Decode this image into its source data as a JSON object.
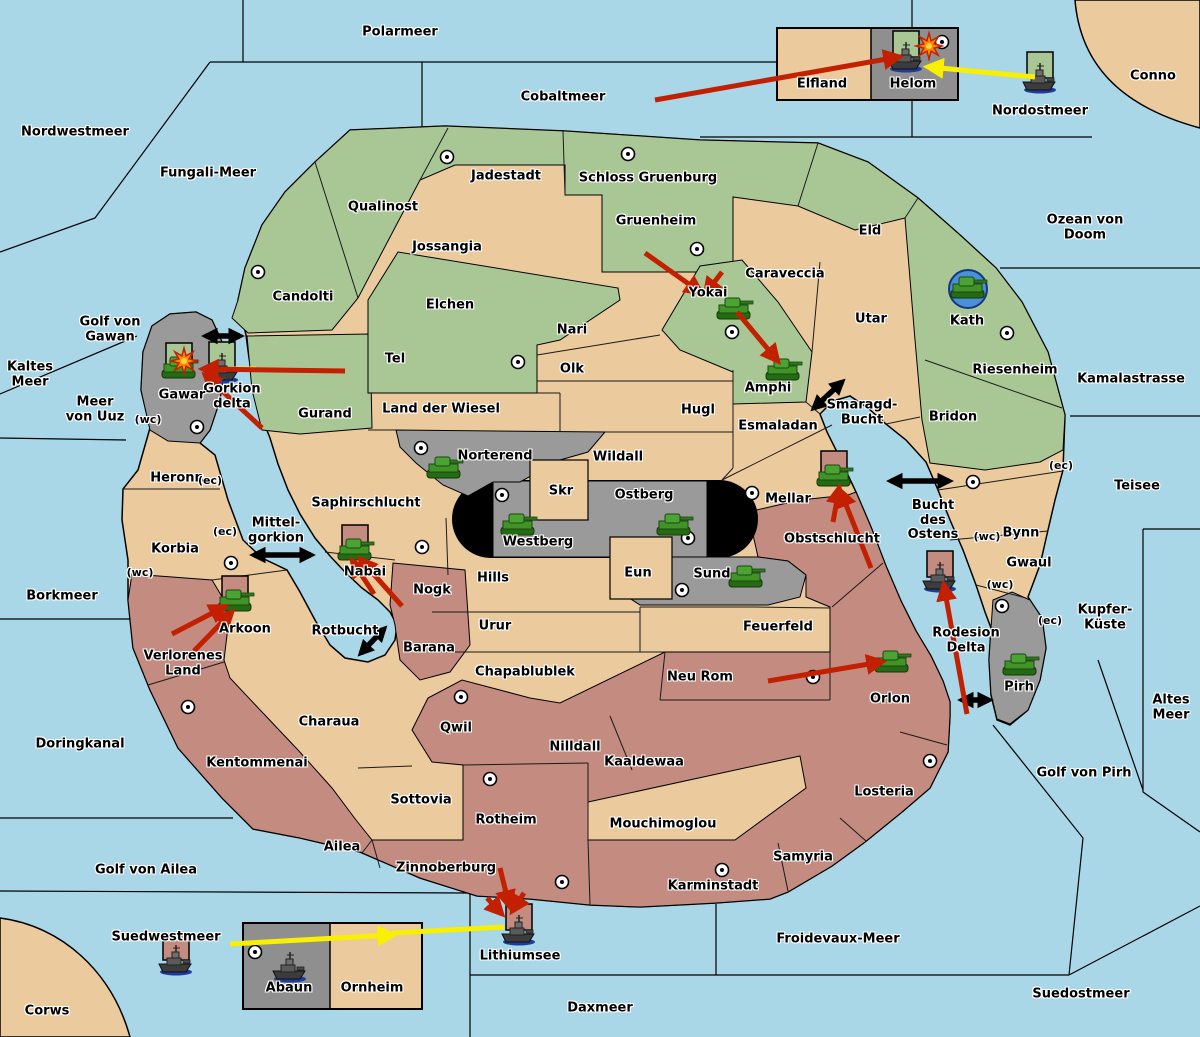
{
  "palette": {
    "sea": "#A9D7E8",
    "tan": "#EBCA9E",
    "green": "#A9C795",
    "gray": "#9A9A9A",
    "dark_gray": "#8F8F8F",
    "rose": "#C48B80",
    "black": "#000000",
    "red": "#C22000",
    "yellow": "#F8F000",
    "explosion": "#FF8A00",
    "city_fill": "#FFFFFF",
    "flag_green": "#A9C795",
    "flag_rose": "#C48B80",
    "kath_circle": "#4A90D9"
  },
  "seas": [
    {
      "name": "Polarmeer",
      "x": 400,
      "y": 33
    },
    {
      "name": "Cobaltmeer",
      "x": 563,
      "y": 98
    },
    {
      "name": "Nordwestmeer",
      "x": 75,
      "y": 133
    },
    {
      "name": "Fungali-Meer",
      "x": 208,
      "y": 174
    },
    {
      "name": "Nordostmeer",
      "x": 1040,
      "y": 112
    },
    {
      "name": "Ozean von Doom",
      "x": 1085,
      "y": 228
    },
    {
      "name": "Kamalastrasse",
      "x": 1131,
      "y": 380
    },
    {
      "name": "Kaltes\nMeer",
      "x": 30,
      "y": 375
    },
    {
      "name": "Golf von\nGawan",
      "x": 110,
      "y": 330
    },
    {
      "name": "Meer\nvon Uuz",
      "x": 95,
      "y": 410
    },
    {
      "name": "Teisee",
      "x": 1137,
      "y": 487
    },
    {
      "name": "Borkmeer",
      "x": 62,
      "y": 597
    },
    {
      "name": "Kupfer-\nKüste",
      "x": 1105,
      "y": 618
    },
    {
      "name": "Altes\nMeer",
      "x": 1171,
      "y": 708
    },
    {
      "name": "Doringkanal",
      "x": 80,
      "y": 745
    },
    {
      "name": "Golf von Pirh",
      "x": 1084,
      "y": 774
    },
    {
      "name": "Golf von Ailea",
      "x": 146,
      "y": 871
    },
    {
      "name": "Suedwestmeer",
      "x": 166,
      "y": 938
    },
    {
      "name": "Daxmeer",
      "x": 600,
      "y": 1009
    },
    {
      "name": "Froidevaux-Meer",
      "x": 838,
      "y": 940
    },
    {
      "name": "Suedostmeer",
      "x": 1081,
      "y": 995
    },
    {
      "name": "Lithiumsee",
      "x": 520,
      "y": 957
    },
    {
      "name": "Smaragd-\nBucht",
      "x": 862,
      "y": 413
    },
    {
      "name": "Bucht\ndes\nOstens",
      "x": 933,
      "y": 521
    },
    {
      "name": "Mittel-\ngorkion",
      "x": 276,
      "y": 531
    },
    {
      "name": "Rotbucht",
      "x": 345,
      "y": 632
    },
    {
      "name": "Gorkion\ndelta",
      "x": 232,
      "y": 397
    },
    {
      "name": "Rodesion\nDelta",
      "x": 966,
      "y": 641
    }
  ],
  "regions": [
    {
      "name": "Jadestadt",
      "x": 506,
      "y": 177,
      "terrain": "green"
    },
    {
      "name": "Schloss Gruenburg",
      "x": 648,
      "y": 179,
      "terrain": "green"
    },
    {
      "name": "Qualinost",
      "x": 383,
      "y": 208,
      "terrain": "green"
    },
    {
      "name": "Jossangia",
      "x": 447,
      "y": 248,
      "terrain": "tan"
    },
    {
      "name": "Gruenheim",
      "x": 656,
      "y": 222,
      "terrain": "green"
    },
    {
      "name": "Candolti",
      "x": 303,
      "y": 298,
      "terrain": "green"
    },
    {
      "name": "Elchen",
      "x": 450,
      "y": 306,
      "terrain": "green"
    },
    {
      "name": "Caraveccia",
      "x": 785,
      "y": 275,
      "terrain": "tan"
    },
    {
      "name": "Eld",
      "x": 870,
      "y": 232,
      "terrain": "green"
    },
    {
      "name": "Utar",
      "x": 871,
      "y": 320,
      "terrain": "tan"
    },
    {
      "name": "Kath",
      "x": 967,
      "y": 322,
      "terrain": "green"
    },
    {
      "name": "Yokai",
      "x": 708,
      "y": 294,
      "terrain": "green"
    },
    {
      "name": "Nari",
      "x": 572,
      "y": 331,
      "terrain": "tan"
    },
    {
      "name": "Tel",
      "x": 395,
      "y": 360,
      "terrain": "green"
    },
    {
      "name": "Olk",
      "x": 572,
      "y": 370,
      "terrain": "tan"
    },
    {
      "name": "Riesenheim",
      "x": 1015,
      "y": 371,
      "terrain": "green"
    },
    {
      "name": "Bridon",
      "x": 953,
      "y": 418,
      "terrain": "tan"
    },
    {
      "name": "Land der Wiesel",
      "x": 441,
      "y": 410,
      "terrain": "tan"
    },
    {
      "name": "Hugl",
      "x": 698,
      "y": 411,
      "terrain": "tan"
    },
    {
      "name": "Esmaladan",
      "x": 778,
      "y": 427,
      "terrain": "tan"
    },
    {
      "name": "Amphi",
      "x": 768,
      "y": 389,
      "terrain": "green"
    },
    {
      "name": "Gurand",
      "x": 325,
      "y": 415,
      "terrain": "green"
    },
    {
      "name": "Norterend",
      "x": 495,
      "y": 457,
      "terrain": "gray"
    },
    {
      "name": "Wildall",
      "x": 618,
      "y": 458,
      "terrain": "tan"
    },
    {
      "name": "Skr",
      "x": 561,
      "y": 492,
      "terrain": "tan"
    },
    {
      "name": "Ostberg",
      "x": 644,
      "y": 496,
      "terrain": "gray"
    },
    {
      "name": "Mellar",
      "x": 788,
      "y": 500,
      "terrain": "tan"
    },
    {
      "name": "Saphirschlucht",
      "x": 366,
      "y": 504,
      "terrain": "tan"
    },
    {
      "name": "Westberg",
      "x": 538,
      "y": 543,
      "terrain": "gray"
    },
    {
      "name": "Obstschlucht",
      "x": 832,
      "y": 540,
      "terrain": "rose"
    },
    {
      "name": "Bynn",
      "x": 1021,
      "y": 534,
      "terrain": "tan"
    },
    {
      "name": "Heronn",
      "x": 177,
      "y": 479,
      "terrain": "tan"
    },
    {
      "name": "Gwaul",
      "x": 1029,
      "y": 564,
      "terrain": "tan"
    },
    {
      "name": "Korbia",
      "x": 175,
      "y": 550,
      "terrain": "tan"
    },
    {
      "name": "Nabai",
      "x": 365,
      "y": 573,
      "terrain": "tan"
    },
    {
      "name": "Nogk",
      "x": 432,
      "y": 591,
      "terrain": "rose"
    },
    {
      "name": "Hills",
      "x": 493,
      "y": 579,
      "terrain": "tan"
    },
    {
      "name": "Eun",
      "x": 638,
      "y": 574,
      "terrain": "tan"
    },
    {
      "name": "Sund",
      "x": 712,
      "y": 575,
      "terrain": "gray"
    },
    {
      "name": "Urur",
      "x": 495,
      "y": 627,
      "terrain": "tan"
    },
    {
      "name": "Feuerfeld",
      "x": 778,
      "y": 628,
      "terrain": "tan"
    },
    {
      "name": "Arkoon",
      "x": 245,
      "y": 630,
      "terrain": "tan"
    },
    {
      "name": "Verlorenes\nLand",
      "x": 183,
      "y": 664,
      "terrain": "rose"
    },
    {
      "name": "Barana",
      "x": 429,
      "y": 649,
      "terrain": "rose"
    },
    {
      "name": "Chapablublek",
      "x": 525,
      "y": 673,
      "terrain": "tan"
    },
    {
      "name": "Neu Rom",
      "x": 700,
      "y": 678,
      "terrain": "rose"
    },
    {
      "name": "Orlon",
      "x": 890,
      "y": 700,
      "terrain": "rose"
    },
    {
      "name": "Pirh",
      "x": 1019,
      "y": 688,
      "terrain": "gray"
    },
    {
      "name": "Charaua",
      "x": 329,
      "y": 723,
      "terrain": "tan"
    },
    {
      "name": "Qwil",
      "x": 456,
      "y": 729,
      "terrain": "rose"
    },
    {
      "name": "Nilldall",
      "x": 575,
      "y": 748,
      "terrain": "rose"
    },
    {
      "name": "Kaaldewaa",
      "x": 644,
      "y": 763,
      "terrain": "rose"
    },
    {
      "name": "Kentommenai",
      "x": 257,
      "y": 764,
      "terrain": "rose"
    },
    {
      "name": "Sottovia",
      "x": 421,
      "y": 801,
      "terrain": "tan"
    },
    {
      "name": "Rotheim",
      "x": 506,
      "y": 821,
      "terrain": "rose"
    },
    {
      "name": "Mouchimoglou",
      "x": 663,
      "y": 825,
      "terrain": "tan"
    },
    {
      "name": "Losteria",
      "x": 884,
      "y": 793,
      "terrain": "rose"
    },
    {
      "name": "Ailea",
      "x": 342,
      "y": 848,
      "terrain": "rose"
    },
    {
      "name": "Zinnoberburg",
      "x": 446,
      "y": 869,
      "terrain": "rose"
    },
    {
      "name": "Samyria",
      "x": 803,
      "y": 858,
      "terrain": "rose"
    },
    {
      "name": "Karminstadt",
      "x": 713,
      "y": 887,
      "terrain": "rose"
    },
    {
      "name": "Elfland",
      "x": 822,
      "y": 85,
      "terrain": "tan"
    },
    {
      "name": "Helom",
      "x": 913,
      "y": 85,
      "terrain": "gray"
    },
    {
      "name": "Abaun",
      "x": 289,
      "y": 989,
      "terrain": "gray"
    },
    {
      "name": "Ornheim",
      "x": 372,
      "y": 989,
      "terrain": "tan"
    },
    {
      "name": "Gawar",
      "x": 182,
      "y": 396,
      "terrain": "gray"
    },
    {
      "name": "Conno",
      "x": 1153,
      "y": 77,
      "terrain": "tan"
    },
    {
      "name": "Corws",
      "x": 47,
      "y": 1012,
      "terrain": "tan"
    }
  ],
  "coast_markers": [
    {
      "text": "(wc)",
      "x": 148,
      "y": 420
    },
    {
      "text": "(ec)",
      "x": 210,
      "y": 481
    },
    {
      "text": "(ec)",
      "x": 225,
      "y": 532
    },
    {
      "text": "(wc)",
      "x": 140,
      "y": 573
    },
    {
      "text": "(ec)",
      "x": 1061,
      "y": 466
    },
    {
      "text": "(wc)",
      "x": 987,
      "y": 537
    },
    {
      "text": "(wc)",
      "x": 1000,
      "y": 585
    },
    {
      "text": "(ec)",
      "x": 1050,
      "y": 621
    }
  ],
  "cities": [
    {
      "x": 447,
      "y": 157,
      "region": "Jadestadt"
    },
    {
      "x": 628,
      "y": 154,
      "region": "Schloss Gruenburg"
    },
    {
      "x": 697,
      "y": 249,
      "region": "Gruenheim"
    },
    {
      "x": 258,
      "y": 272,
      "region": "Candolti"
    },
    {
      "x": 732,
      "y": 332,
      "region": "Yokai"
    },
    {
      "x": 518,
      "y": 362,
      "region": "Tel"
    },
    {
      "x": 1007,
      "y": 333,
      "region": "Kath"
    },
    {
      "x": 197,
      "y": 427,
      "region": "Gawar"
    },
    {
      "x": 421,
      "y": 448,
      "region": "Norterend"
    },
    {
      "x": 502,
      "y": 495,
      "region": "Westberg"
    },
    {
      "x": 688,
      "y": 538,
      "region": "Ostberg"
    },
    {
      "x": 682,
      "y": 590,
      "region": "Sund"
    },
    {
      "x": 752,
      "y": 493,
      "region": "Mellar"
    },
    {
      "x": 422,
      "y": 547,
      "region": "Saphirschlucht"
    },
    {
      "x": 231,
      "y": 563,
      "region": "Korbia"
    },
    {
      "x": 973,
      "y": 482,
      "region": "Bynn"
    },
    {
      "x": 188,
      "y": 707,
      "region": "Verlorenes Land"
    },
    {
      "x": 461,
      "y": 697,
      "region": "Qwil"
    },
    {
      "x": 813,
      "y": 677,
      "region": "Neu Rom"
    },
    {
      "x": 490,
      "y": 779,
      "region": "Rotheim"
    },
    {
      "x": 562,
      "y": 882,
      "region": "Zinnoberburg"
    },
    {
      "x": 722,
      "y": 870,
      "region": "Karminstadt"
    },
    {
      "x": 930,
      "y": 761,
      "region": "Losteria"
    },
    {
      "x": 942,
      "y": 42,
      "region": "Helom"
    },
    {
      "x": 255,
      "y": 952,
      "region": "Abaun"
    },
    {
      "x": 1002,
      "y": 606,
      "region": "Pirh"
    }
  ],
  "units": [
    {
      "type": "ship",
      "x": 906,
      "y": 57,
      "flag": "green",
      "region": "Helom"
    },
    {
      "type": "ship",
      "x": 1040,
      "y": 78,
      "flag": "green",
      "region": "Nordostmeer"
    },
    {
      "type": "ship",
      "x": 222,
      "y": 368,
      "flag": "green",
      "region": "Gorkion delta"
    },
    {
      "type": "tank",
      "x": 179,
      "y": 369,
      "flag": "green",
      "region": "Gawar"
    },
    {
      "type": "tank",
      "x": 734,
      "y": 310,
      "flag": null,
      "region": "Yokai"
    },
    {
      "type": "tank",
      "x": 783,
      "y": 371,
      "flag": null,
      "region": "Amphi"
    },
    {
      "type": "tank",
      "x": 968,
      "y": 289,
      "flag": null,
      "circled": true,
      "region": "Kath"
    },
    {
      "type": "tank",
      "x": 444,
      "y": 469,
      "flag": null,
      "region": "Norterend"
    },
    {
      "type": "tank",
      "x": 518,
      "y": 526,
      "flag": null,
      "region": "Westberg"
    },
    {
      "type": "tank",
      "x": 674,
      "y": 526,
      "flag": null,
      "region": "Ostberg"
    },
    {
      "type": "tank",
      "x": 746,
      "y": 578,
      "flag": null,
      "region": "Sund"
    },
    {
      "type": "tank",
      "x": 834,
      "y": 477,
      "flag": "rose",
      "region": "Mellar"
    },
    {
      "type": "tank",
      "x": 355,
      "y": 551,
      "flag": "rose",
      "region": "Nabai"
    },
    {
      "type": "tank",
      "x": 235,
      "y": 602,
      "flag": "rose",
      "region": "Arkoon"
    },
    {
      "type": "tank",
      "x": 892,
      "y": 663,
      "flag": null,
      "region": "Orlon"
    },
    {
      "type": "tank",
      "x": 1020,
      "y": 666,
      "flag": null,
      "region": "Pirh"
    },
    {
      "type": "ship",
      "x": 940,
      "y": 577,
      "flag": "rose",
      "region": "Rodesion Delta"
    },
    {
      "type": "ship",
      "x": 176,
      "y": 960,
      "flag": "rose",
      "region": "Suedwestmeer"
    },
    {
      "type": "ship",
      "x": 519,
      "y": 930,
      "flag": "rose",
      "region": "Lithiumsee"
    },
    {
      "type": "ship",
      "x": 290,
      "y": 967,
      "flag": null,
      "region": "Abaun"
    }
  ],
  "explosions": [
    {
      "x": 184,
      "y": 361
    },
    {
      "x": 929,
      "y": 46
    }
  ],
  "attack_arrows_red": [
    [
      655,
      100,
      898,
      57
    ],
    [
      645,
      253,
      700,
      292
    ],
    [
      722,
      272,
      706,
      293
    ],
    [
      737,
      312,
      777,
      360
    ],
    [
      345,
      371,
      204,
      369
    ],
    [
      262,
      428,
      206,
      376
    ],
    [
      871,
      568,
      841,
      492
    ],
    [
      833,
      522,
      839,
      489
    ],
    [
      402,
      606,
      361,
      560
    ],
    [
      374,
      594,
      353,
      562
    ],
    [
      172,
      634,
      224,
      607
    ],
    [
      194,
      651,
      231,
      613
    ],
    [
      768,
      681,
      881,
      662
    ],
    [
      967,
      714,
      944,
      586
    ],
    [
      500,
      868,
      509,
      905
    ],
    [
      487,
      898,
      501,
      913
    ],
    [
      524,
      893,
      513,
      910
    ]
  ],
  "move_arrows_yellow": [
    [
      1035,
      77,
      929,
      67
    ],
    [
      230,
      944,
      392,
      935
    ]
  ],
  "move_lines_yellow": [
    [
      392,
      933,
      504,
      927
    ],
    [
      234,
      369,
      256,
      369
    ]
  ],
  "strait_links_black": [
    [
      206,
      336,
      240,
      336
    ],
    [
      814,
      408,
      842,
      382
    ],
    [
      891,
      481,
      949,
      481
    ],
    [
      254,
      555,
      311,
      555
    ],
    [
      361,
      653,
      384,
      629
    ],
    [
      962,
      700,
      989,
      700
    ]
  ]
}
